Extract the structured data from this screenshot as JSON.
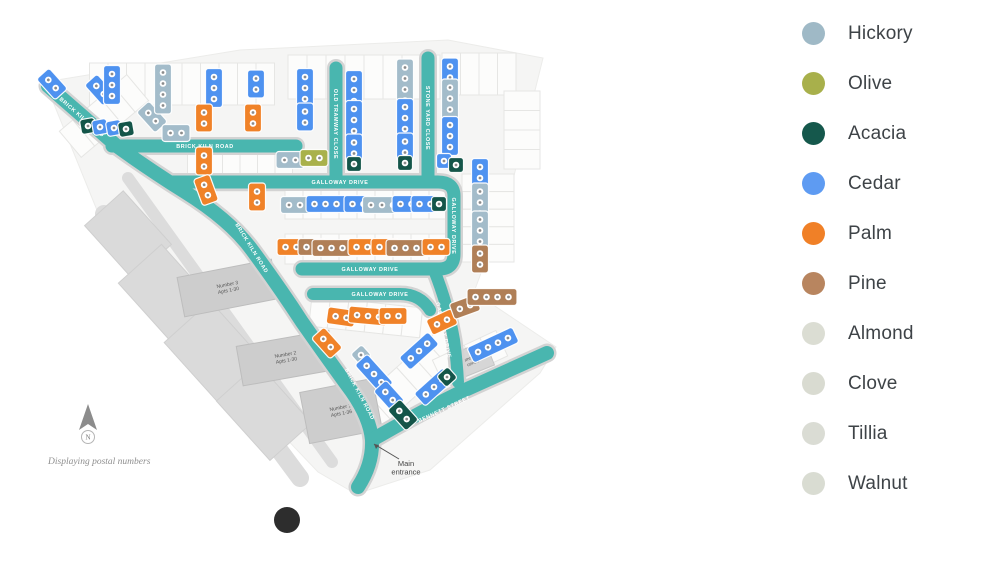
{
  "legend": {
    "items": [
      {
        "label": "Hickory",
        "color": "#9FB9C6"
      },
      {
        "label": "Olive",
        "color": "#A8B04B"
      },
      {
        "label": "Acacia",
        "color": "#15584C"
      },
      {
        "label": "Cedar",
        "color": "#5E9BF2"
      },
      {
        "label": "Palm",
        "color": "#F08027"
      },
      {
        "label": "Pine",
        "color": "#B8855F"
      },
      {
        "label": "Almond",
        "color": "#DBDDD3"
      },
      {
        "label": "Clove",
        "color": "#D9DBD1"
      },
      {
        "label": "Tillia",
        "color": "#DADCD4"
      },
      {
        "label": "Walnut",
        "color": "#D9DCD2"
      }
    ]
  },
  "map": {
    "palette": {
      "cedar": "#4E92F0",
      "palm": "#F08228",
      "acacia": "#145549",
      "hickory": "#A3BCCA",
      "olive": "#A9B14B",
      "pine": "#B07F57"
    },
    "road_color": "#49B6AF",
    "road_casing": "#D3D3D3",
    "base_color": "#F5F5F4",
    "boundary": "45,82 240,50 448,40 543,58 508,200 474,292 556,347 540,373 430,470 356,494 318,472 118,262",
    "roads": [
      {
        "d": "M48,86 L118,147 Q150,170 185,192 Q230,220 252,250 Q280,288 302,322 Q330,362 352,392 Q370,418 372,440 Q373,464 358,487",
        "w": 14
      },
      {
        "d": "M112,146 L296,146",
        "w": 13
      },
      {
        "d": "M336,68 L336,182",
        "w": 13
      },
      {
        "d": "M428,58 L428,182",
        "w": 13
      },
      {
        "d": "M172,182 L438,182 Q454,182 454,196 L454,254 Q454,269 439,269 L302,269",
        "w": 13
      },
      {
        "d": "M434,270 Q448,305 454,340 Q457,362 458,382",
        "w": 12
      },
      {
        "d": "M313,294 L400,294 Q420,294 430,310",
        "w": 12
      },
      {
        "d": "M547,353 Q505,372 465,390 Q420,412 372,440",
        "w": 14
      }
    ],
    "road_labels": [
      {
        "text": "BRICK KILN ROAD",
        "x": 82,
        "y": 117,
        "r": 41
      },
      {
        "text": "BRICK KILN ROAD",
        "x": 205,
        "y": 146,
        "r": 0
      },
      {
        "text": "BRICK KILN ROAD",
        "x": 252,
        "y": 248,
        "r": 58
      },
      {
        "text": "BRICK KILN ROAD",
        "x": 360,
        "y": 394,
        "r": 62
      },
      {
        "text": "OLD TRAMWAY CLOSE",
        "x": 336,
        "y": 124,
        "r": 90
      },
      {
        "text": "STONE YARD CLOSE",
        "x": 428,
        "y": 118,
        "r": 90
      },
      {
        "text": "GALLOWAY DRIVE",
        "x": 340,
        "y": 182,
        "r": 0
      },
      {
        "text": "GALLOWAY DRIVE",
        "x": 454,
        "y": 226,
        "r": 90
      },
      {
        "text": "GALLOWAY DRIVE",
        "x": 370,
        "y": 269,
        "r": 0
      },
      {
        "text": "GALLOWAY DRIVE",
        "x": 380,
        "y": 294,
        "r": 0
      },
      {
        "text": "GALLOWAY DRIVE",
        "x": 444,
        "y": 330,
        "r": 78
      },
      {
        "text": "BENNETT STREET",
        "x": 444,
        "y": 409,
        "r": -25
      }
    ],
    "plot_strips": [
      {
        "cx": 182,
        "cy": 84,
        "w": 185,
        "h": 42,
        "n": 10,
        "r": 0
      },
      {
        "cx": 364,
        "cy": 77,
        "w": 152,
        "h": 44,
        "n": 8,
        "r": 0
      },
      {
        "cx": 479,
        "cy": 74,
        "w": 74,
        "h": 42,
        "n": 4,
        "r": 0
      },
      {
        "cx": 104,
        "cy": 116,
        "w": 88,
        "h": 34,
        "n": 5,
        "r": -40
      },
      {
        "cx": 240,
        "cy": 170,
        "w": 105,
        "h": 42,
        "n": 6,
        "r": 0
      },
      {
        "cx": 366,
        "cy": 204,
        "w": 162,
        "h": 30,
        "n": 9,
        "r": 0
      },
      {
        "cx": 366,
        "cy": 249,
        "w": 162,
        "h": 30,
        "n": 9,
        "r": 0
      },
      {
        "cx": 488,
        "cy": 218,
        "w": 88,
        "h": 52,
        "n": 5,
        "r": 90
      },
      {
        "cx": 522,
        "cy": 130,
        "w": 78,
        "h": 36,
        "n": 4,
        "r": 90
      },
      {
        "cx": 375,
        "cy": 318,
        "w": 130,
        "h": 30,
        "n": 7,
        "r": 6
      },
      {
        "cx": 408,
        "cy": 380,
        "w": 118,
        "h": 34,
        "n": 6,
        "r": -42
      },
      {
        "cx": 470,
        "cy": 358,
        "w": 70,
        "h": 28,
        "n": 4,
        "r": -25
      }
    ],
    "gray_buildings": [
      {
        "cx": 128,
        "cy": 235,
        "w": 52,
        "h": 72,
        "r": -42
      },
      {
        "cx": 168,
        "cy": 295,
        "w": 58,
        "h": 84,
        "r": -42
      },
      {
        "cx": 218,
        "cy": 356,
        "w": 62,
        "h": 92,
        "r": -42
      },
      {
        "cx": 264,
        "cy": 412,
        "w": 56,
        "h": 80,
        "r": -42
      },
      {
        "cx": 158,
        "cy": 108,
        "w": 34,
        "h": 14,
        "r": -42
      }
    ],
    "gray_paths": [
      {
        "d": "M128,178 L332,462",
        "w": 12
      },
      {
        "d": "M104,214 L300,478",
        "w": 18
      }
    ],
    "apartments": [
      {
        "line1": "Number 3",
        "line2": "Apts 1-30",
        "cx": 228,
        "cy": 288,
        "w": 96,
        "h": 40,
        "r": -11
      },
      {
        "line1": "Number 2",
        "line2": "Apts 1-30",
        "cx": 286,
        "cy": 358,
        "w": 94,
        "h": 40,
        "r": -10
      },
      {
        "line1": "Number 1",
        "line2": "Apts 1-36",
        "cx": 341,
        "cy": 411,
        "w": 74,
        "h": 52,
        "r": -11
      }
    ],
    "community_centre": {
      "line1": "Community",
      "line2": "centre",
      "cx": 472,
      "cy": 360,
      "w": 38,
      "h": 26,
      "r": -22
    },
    "houses": [
      {
        "t": "cedar",
        "x": 52,
        "y": 84,
        "c": 2,
        "o": "v",
        "r": -42
      },
      {
        "t": "cedar",
        "x": 100,
        "y": 90,
        "c": 2,
        "o": "v",
        "r": -42
      },
      {
        "t": "hickory",
        "x": 152,
        "y": 117,
        "c": 2,
        "o": "v",
        "r": -42
      },
      {
        "t": "acacia",
        "x": 88,
        "y": 126,
        "c": 1,
        "o": "s",
        "r": -10
      },
      {
        "t": "cedar",
        "x": 100,
        "y": 127,
        "c": 1,
        "o": "s",
        "r": -10
      },
      {
        "t": "cedar",
        "x": 114,
        "y": 128,
        "c": 1,
        "o": "s",
        "r": -10
      },
      {
        "t": "acacia",
        "x": 126,
        "y": 129,
        "c": 1,
        "o": "s",
        "r": -10
      },
      {
        "t": "cedar",
        "x": 112,
        "y": 85,
        "c": 3,
        "o": "v",
        "r": 0
      },
      {
        "t": "hickory",
        "x": 163,
        "y": 89,
        "c": 4,
        "o": "v",
        "r": 0
      },
      {
        "t": "cedar",
        "x": 214,
        "y": 88,
        "c": 3,
        "o": "v",
        "r": 0
      },
      {
        "t": "cedar",
        "x": 256,
        "y": 84,
        "c": 2,
        "o": "v",
        "r": 0
      },
      {
        "t": "cedar",
        "x": 305,
        "y": 88,
        "c": 3,
        "o": "v",
        "r": 0
      },
      {
        "t": "cedar",
        "x": 305,
        "y": 117,
        "c": 2,
        "o": "v",
        "r": 0
      },
      {
        "t": "cedar",
        "x": 354,
        "y": 90,
        "c": 3,
        "o": "v",
        "r": 0
      },
      {
        "t": "cedar",
        "x": 354,
        "y": 120,
        "c": 3,
        "o": "v",
        "r": 0
      },
      {
        "t": "cedar",
        "x": 354,
        "y": 148,
        "c": 2,
        "o": "v",
        "r": 0
      },
      {
        "t": "acacia",
        "x": 354,
        "y": 164,
        "c": 1,
        "o": "s",
        "r": 0
      },
      {
        "t": "hickory",
        "x": 405,
        "y": 84,
        "c": 4,
        "o": "v",
        "r": 0
      },
      {
        "t": "cedar",
        "x": 405,
        "y": 118,
        "c": 3,
        "o": "v",
        "r": 0
      },
      {
        "t": "cedar",
        "x": 405,
        "y": 147,
        "c": 2,
        "o": "v",
        "r": 0
      },
      {
        "t": "acacia",
        "x": 405,
        "y": 163,
        "c": 1,
        "o": "s",
        "r": 0
      },
      {
        "t": "cedar",
        "x": 450,
        "y": 72,
        "c": 2,
        "o": "v",
        "r": 0
      },
      {
        "t": "hickory",
        "x": 450,
        "y": 104,
        "c": 4,
        "o": "v",
        "r": 0
      },
      {
        "t": "cedar",
        "x": 450,
        "y": 136,
        "c": 3,
        "o": "v",
        "r": 0
      },
      {
        "t": "cedar",
        "x": 444,
        "y": 161,
        "c": 1,
        "o": "s",
        "r": 0
      },
      {
        "t": "acacia",
        "x": 456,
        "y": 165,
        "c": 1,
        "o": "s",
        "r": 0
      },
      {
        "t": "cedar",
        "x": 480,
        "y": 178,
        "c": 3,
        "o": "v",
        "r": 0
      },
      {
        "t": "hickory",
        "x": 480,
        "y": 208,
        "c": 4,
        "o": "v",
        "r": 0
      },
      {
        "t": "hickory",
        "x": 480,
        "y": 236,
        "c": 4,
        "o": "v",
        "r": 0
      },
      {
        "t": "pine",
        "x": 480,
        "y": 259,
        "c": 2,
        "o": "v",
        "r": 0
      },
      {
        "t": "palm",
        "x": 204,
        "y": 118,
        "c": 2,
        "o": "v",
        "r": 0
      },
      {
        "t": "palm",
        "x": 253,
        "y": 118,
        "c": 2,
        "o": "v",
        "r": 0
      },
      {
        "t": "hickory",
        "x": 176,
        "y": 133,
        "c": 2,
        "o": "h",
        "r": 0
      },
      {
        "t": "palm",
        "x": 204,
        "y": 161,
        "c": 2,
        "o": "v",
        "r": 0
      },
      {
        "t": "palm",
        "x": 206,
        "y": 190,
        "c": 2,
        "o": "v",
        "r": -20
      },
      {
        "t": "palm",
        "x": 257,
        "y": 197,
        "c": 2,
        "o": "v",
        "r": 0
      },
      {
        "t": "hickory",
        "x": 290,
        "y": 160,
        "c": 2,
        "o": "h",
        "r": 0
      },
      {
        "t": "olive",
        "x": 314,
        "y": 158,
        "c": 2,
        "o": "h",
        "r": 0
      },
      {
        "t": "hickory",
        "x": 300,
        "y": 205,
        "c": 3,
        "o": "h",
        "r": 0
      },
      {
        "t": "cedar",
        "x": 331,
        "y": 204,
        "c": 4,
        "o": "h",
        "r": 0
      },
      {
        "t": "cedar",
        "x": 358,
        "y": 204,
        "c": 2,
        "o": "h",
        "r": 0
      },
      {
        "t": "hickory",
        "x": 382,
        "y": 205,
        "c": 3,
        "o": "h",
        "r": 0
      },
      {
        "t": "cedar",
        "x": 406,
        "y": 204,
        "c": 2,
        "o": "h",
        "r": 0
      },
      {
        "t": "cedar",
        "x": 425,
        "y": 204,
        "c": 2,
        "o": "h",
        "r": 0
      },
      {
        "t": "acacia",
        "x": 439,
        "y": 204,
        "c": 1,
        "o": "s",
        "r": 0
      },
      {
        "t": "palm",
        "x": 291,
        "y": 247,
        "c": 2,
        "o": "h",
        "r": 0
      },
      {
        "t": "pine",
        "x": 312,
        "y": 247,
        "c": 2,
        "o": "h",
        "r": 0
      },
      {
        "t": "pine",
        "x": 337,
        "y": 248,
        "c": 4,
        "o": "h",
        "r": 0
      },
      {
        "t": "palm",
        "x": 362,
        "y": 247,
        "c": 2,
        "o": "h",
        "r": 0
      },
      {
        "t": "palm",
        "x": 385,
        "y": 247,
        "c": 2,
        "o": "h",
        "r": 0
      },
      {
        "t": "pine",
        "x": 411,
        "y": 248,
        "c": 4,
        "o": "h",
        "r": 0
      },
      {
        "t": "palm",
        "x": 436,
        "y": 247,
        "c": 2,
        "o": "h",
        "r": 0
      },
      {
        "t": "palm",
        "x": 341,
        "y": 317,
        "c": 2,
        "o": "h",
        "r": 8
      },
      {
        "t": "palm",
        "x": 368,
        "y": 316,
        "c": 3,
        "o": "h",
        "r": 5
      },
      {
        "t": "palm",
        "x": 393,
        "y": 316,
        "c": 2,
        "o": "h",
        "r": 0
      },
      {
        "t": "palm",
        "x": 327,
        "y": 343,
        "c": 2,
        "o": "v",
        "r": -42
      },
      {
        "t": "palm",
        "x": 442,
        "y": 322,
        "c": 2,
        "o": "h",
        "r": -25
      },
      {
        "t": "pine",
        "x": 465,
        "y": 307,
        "c": 2,
        "o": "h",
        "r": -20
      },
      {
        "t": "pine",
        "x": 492,
        "y": 297,
        "c": 4,
        "o": "h",
        "r": 0
      },
      {
        "t": "hickory",
        "x": 361,
        "y": 355,
        "c": 1,
        "o": "s",
        "r": -42
      },
      {
        "t": "cedar",
        "x": 374,
        "y": 374,
        "c": 3,
        "o": "v",
        "r": -42
      },
      {
        "t": "cedar",
        "x": 389,
        "y": 396,
        "c": 2,
        "o": "v",
        "r": -42
      },
      {
        "t": "acacia",
        "x": 403,
        "y": 415,
        "c": 2,
        "o": "v",
        "r": -42
      },
      {
        "t": "cedar",
        "x": 419,
        "y": 351,
        "c": 3,
        "o": "h",
        "r": -42
      },
      {
        "t": "cedar",
        "x": 434,
        "y": 387,
        "c": 3,
        "o": "h",
        "r": -42
      },
      {
        "t": "acacia",
        "x": 447,
        "y": 377,
        "c": 1,
        "o": "s",
        "r": -42
      },
      {
        "t": "cedar",
        "x": 493,
        "y": 345,
        "c": 4,
        "o": "h",
        "r": -25
      }
    ],
    "north": {
      "label": "N",
      "x": 88,
      "y": 420
    },
    "footnote": {
      "text": "Displaying postal numbers",
      "x": 48,
      "y": 464
    },
    "entrance": {
      "line1": "Main",
      "line2": "entrance",
      "x": 406,
      "y": 466,
      "arrow_from_x": 399,
      "arrow_from_y": 459,
      "arrow_to_x": 374,
      "arrow_to_y": 444
    },
    "marker": {
      "x": 287,
      "y": 520,
      "radius": 13,
      "color": "#2D2D2D"
    }
  }
}
